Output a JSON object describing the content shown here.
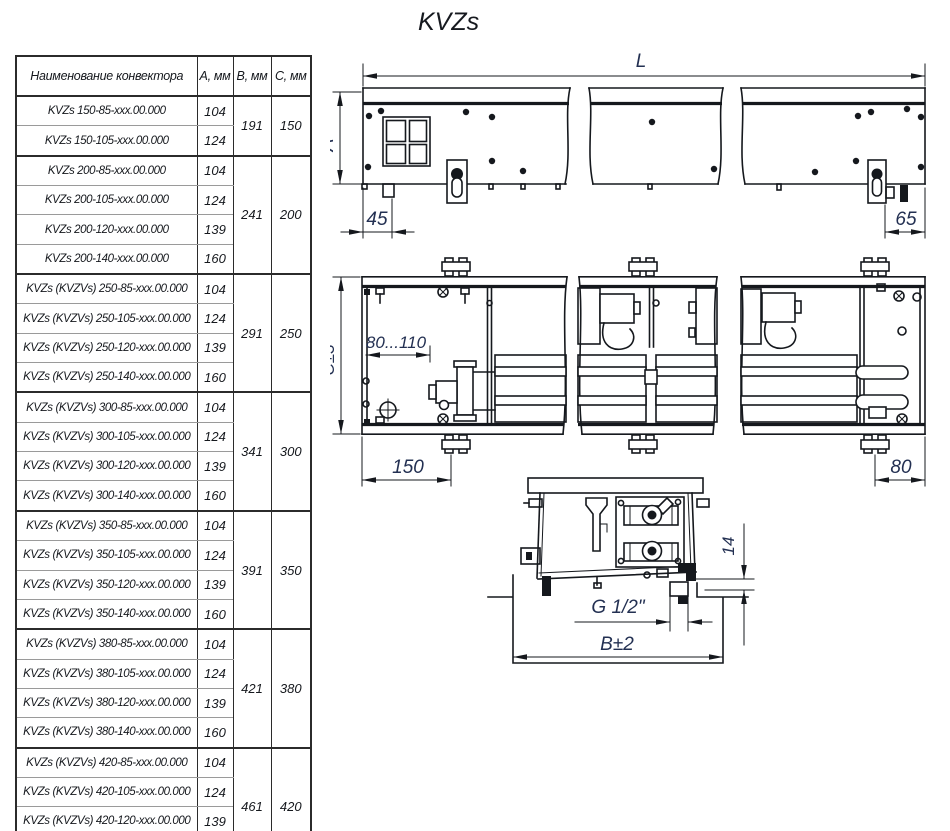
{
  "title": "KVZs",
  "table": {
    "headers": [
      "Наименование конвектора",
      "А, мм",
      "В, мм",
      "С, мм"
    ],
    "groups": [
      {
        "b": "191",
        "c": "150",
        "rows": [
          {
            "name": "KVZs 150-85-xxx.00.000",
            "a": "104"
          },
          {
            "name": "KVZs 150-105-xxx.00.000",
            "a": "124"
          }
        ]
      },
      {
        "b": "241",
        "c": "200",
        "rows": [
          {
            "name": "KVZs 200-85-xxx.00.000",
            "a": "104"
          },
          {
            "name": "KVZs 200-105-xxx.00.000",
            "a": "124"
          },
          {
            "name": "KVZs 200-120-xxx.00.000",
            "a": "139"
          },
          {
            "name": "KVZs 200-140-xxx.00.000",
            "a": "160"
          }
        ]
      },
      {
        "b": "291",
        "c": "250",
        "rows": [
          {
            "name": "KVZs (KVZVs) 250-85-xxx.00.000",
            "a": "104"
          },
          {
            "name": "KVZs (KVZVs) 250-105-xxx.00.000",
            "a": "124"
          },
          {
            "name": "KVZs (KVZVs) 250-120-xxx.00.000",
            "a": "139"
          },
          {
            "name": "KVZs (KVZVs) 250-140-xxx.00.000",
            "a": "160"
          }
        ]
      },
      {
        "b": "341",
        "c": "300",
        "rows": [
          {
            "name": "KVZs (KVZVs) 300-85-xxx.00.000",
            "a": "104"
          },
          {
            "name": "KVZs (KVZVs) 300-105-xxx.00.000",
            "a": "124"
          },
          {
            "name": "KVZs (KVZVs) 300-120-xxx.00.000",
            "a": "139"
          },
          {
            "name": "KVZs (KVZVs) 300-140-xxx.00.000",
            "a": "160"
          }
        ]
      },
      {
        "b": "391",
        "c": "350",
        "rows": [
          {
            "name": "KVZs (KVZVs) 350-85-xxx.00.000",
            "a": "104"
          },
          {
            "name": "KVZs (KVZVs) 350-105-xxx.00.000",
            "a": "124"
          },
          {
            "name": "KVZs (KVZVs) 350-120-xxx.00.000",
            "a": "139"
          },
          {
            "name": "KVZs (KVZVs) 350-140-xxx.00.000",
            "a": "160"
          }
        ]
      },
      {
        "b": "421",
        "c": "380",
        "rows": [
          {
            "name": "KVZs (KVZVs) 380-85-xxx.00.000",
            "a": "104"
          },
          {
            "name": "KVZs (KVZVs) 380-105-xxx.00.000",
            "a": "124"
          },
          {
            "name": "KVZs (KVZVs) 380-120-xxx.00.000",
            "a": "139"
          },
          {
            "name": "KVZs (KVZVs) 380-140-xxx.00.000",
            "a": "160"
          }
        ]
      },
      {
        "b": "461",
        "c": "420",
        "rows": [
          {
            "name": "KVZs (KVZVs) 420-85-xxx.00.000",
            "a": "104"
          },
          {
            "name": "KVZs (KVZVs) 420-105-xxx.00.000",
            "a": "124"
          },
          {
            "name": "KVZs (KVZVs) 420-120-xxx.00.000",
            "a": "139"
          },
          {
            "name": "KVZs (KVZVs) 420-140-xxx.00.000",
            "a": "160"
          }
        ]
      }
    ]
  },
  "drawings": {
    "front": {
      "length": "L",
      "height": "A",
      "offset_left": "45",
      "offset_right": "65"
    },
    "plan": {
      "depth": "C±3",
      "inlet_range": "80...110",
      "bracket_left": "150",
      "bracket_right": "80"
    },
    "side": {
      "thread": "G 1/2\"",
      "trench_width": "B±2",
      "gap": "14"
    }
  }
}
